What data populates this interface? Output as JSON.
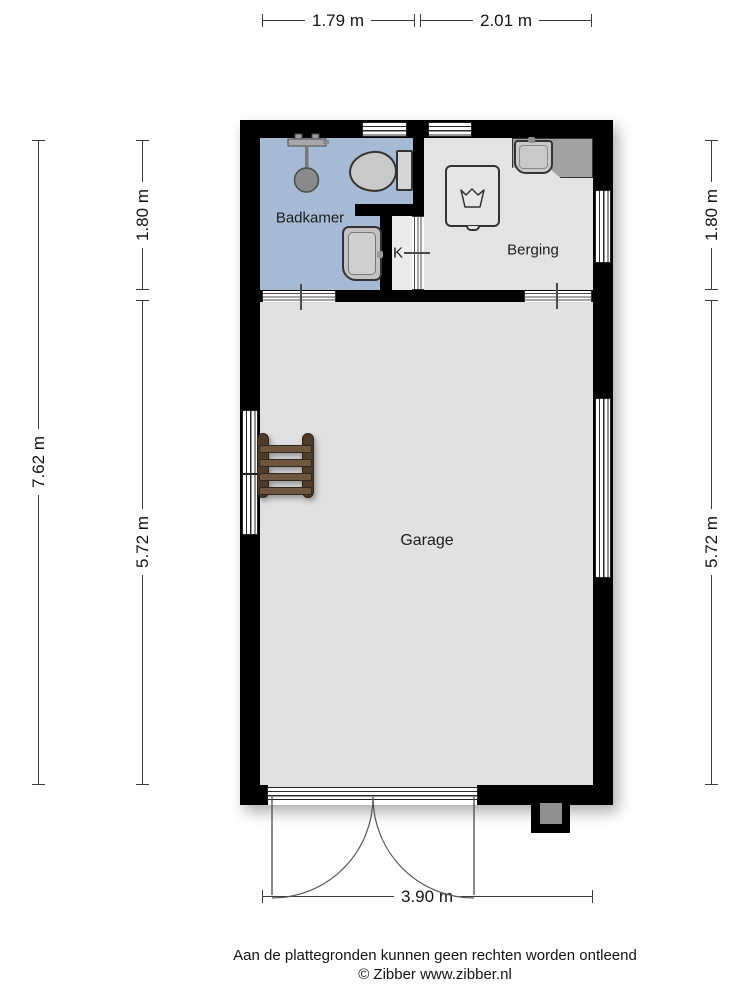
{
  "dimensions": {
    "top_left": "1.79 m",
    "top_right": "2.01 m",
    "left_outer": "7.62 m",
    "left_upper": "1.80 m",
    "left_lower": "5.72 m",
    "right_upper": "1.80 m",
    "right_lower": "5.72 m",
    "bottom": "3.90 m"
  },
  "rooms": {
    "bathroom": "Badkamer",
    "storage": "Berging",
    "closet": "K",
    "garage": "Garage"
  },
  "footer": {
    "disclaimer": "Aan de plattegronden kunnen geen rechten worden ontleend",
    "copyright": "© Zibber www.zibber.nl"
  },
  "colors": {
    "wall": "#000000",
    "bathroom_floor": "#a6bad5",
    "storage_floor": "#e3e3e3",
    "closet_floor": "#ebebeb",
    "garage_floor": "#e1e1e1",
    "fixture_gray": "#c9c9c9",
    "counter_gray": "#a2a2a2",
    "ladder_brown": "#5d4936"
  },
  "fixtures": [
    "shower",
    "toilet",
    "washbasin",
    "counter-with-sink",
    "washing-machine",
    "ladder",
    "chimney",
    "double-garage-door"
  ]
}
